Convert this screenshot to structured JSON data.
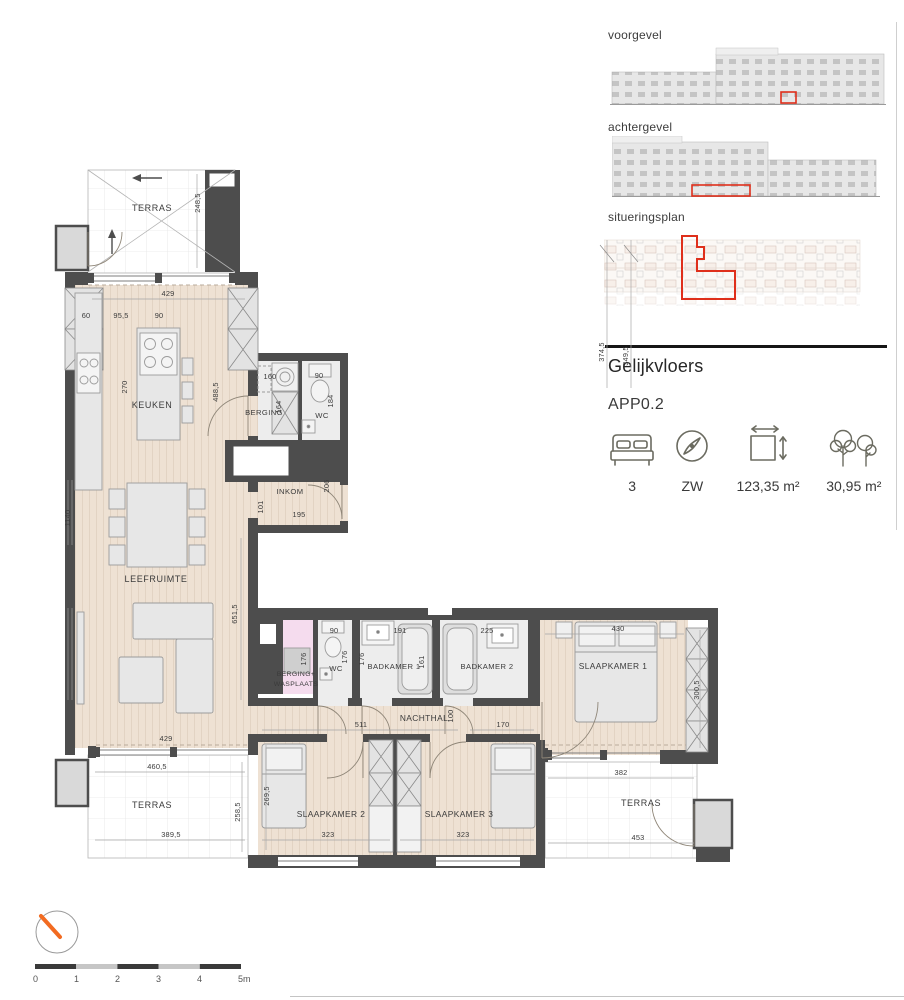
{
  "panel": {
    "voorgevel_label": "voorgevel",
    "achtergevel_label": "achtergevel",
    "situeringsplan_label": "situeringsplan",
    "floor_label": "Gelijkvloers",
    "apartment_id": "APP0.2",
    "stats": {
      "bedrooms": "3",
      "orientation": "ZW",
      "living_area": "123,35 m²",
      "outdoor_area": "30,95 m²"
    },
    "site_dims": {
      "a": "374,5",
      "b": "349,5"
    }
  },
  "plan": {
    "rooms": {
      "terras_top": "TERRAS",
      "keuken": "KEUKEN",
      "leefruimte": "LEEFRUIMTE",
      "berging": "BERGING",
      "wc1": "WC",
      "inkom": "INKOM",
      "berging_wasplaats_1": "BERGING+",
      "berging_wasplaats_2": "WASPLAATS",
      "wc2": "WC",
      "badkamer1": "BADKAMER 1",
      "badkamer2": "BADKAMER 2",
      "slaapkamer1": "SLAAPKAMER 1",
      "nachthal": "NACHTHAL",
      "slaapkamer2": "SLAAPKAMER 2",
      "slaapkamer3": "SLAAPKAMER 3",
      "terras_bl": "TERRAS",
      "terras_br": "TERRAS"
    },
    "dims": {
      "terras_top_h": "248,5",
      "keuken_w": "429",
      "col_w": "60",
      "counter_w": "95,5",
      "island_w": "90",
      "keuken_d": "270",
      "keuken_h": "488,5",
      "living_len": "1140",
      "berging_w": "160",
      "berging_col": "164",
      "wc1_w": "90",
      "wc1_h": "184",
      "inkom_a": "101",
      "inkom_w": "195",
      "inkom_h": "206",
      "living_h": "651,5",
      "living_w": "429",
      "wasplaats_h": "176",
      "wc2_w": "90",
      "wc2_h": "176",
      "badkamer1_h": "176",
      "badkamer1_w": "191",
      "bad1_tub": "161",
      "badkamer2_w": "225",
      "slk1_w": "430",
      "slk1_h": "300,5",
      "nachthal_w": "511",
      "nachthal_h": "100",
      "nachthal_w2": "170",
      "terras_bl_w1": "460,5",
      "terras_bl_w2": "389,5",
      "terras_bl_h": "258,5",
      "slk2_h": "269,5",
      "slk2_w": "323",
      "slk3_w": "323",
      "terras_br_w1": "382",
      "terras_br_w2": "453"
    }
  },
  "scalebar": {
    "ticks": [
      "0",
      "1",
      "2",
      "3",
      "4",
      "5m"
    ]
  },
  "colors": {
    "highlight_red": "#df2f1b",
    "north_orange": "#f26b21",
    "wall": "#4d4d4d"
  }
}
